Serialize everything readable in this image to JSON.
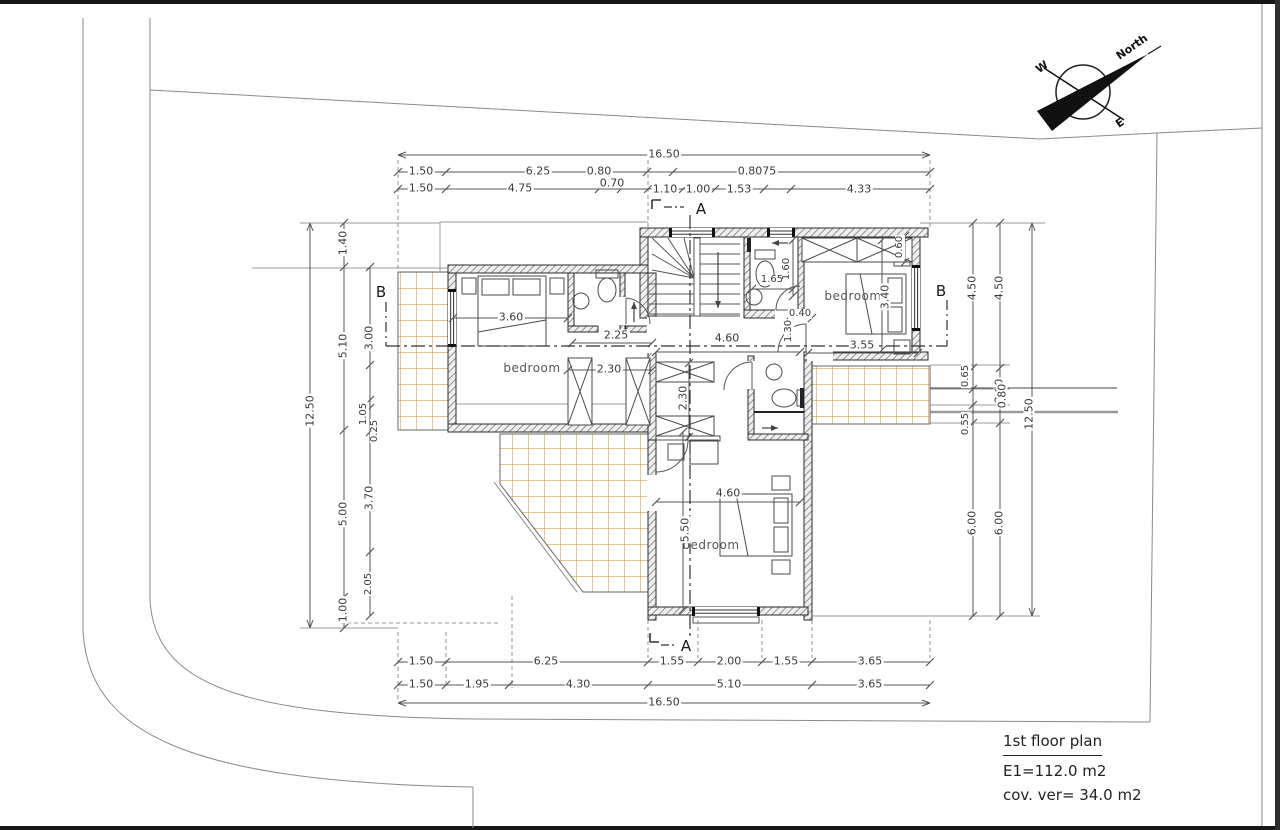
{
  "colors": {
    "tile_line": "#cfa24a",
    "wall_edge": "#2a2a2a",
    "hatch": "#7a7a7a",
    "dim_line": "#555555",
    "text": "#3a3a3a",
    "border": "#161616"
  },
  "title_block": {
    "title": "1st floor plan",
    "area": "E1=112.0 m2",
    "covered_veranda": "cov. ver= 34.0 m2"
  },
  "compass": {
    "north": "North",
    "west": "W",
    "south": "S",
    "east": "E"
  },
  "section_markers": {
    "a_top": "A",
    "a_bottom": "A",
    "b_left": "B",
    "b_right": "B"
  },
  "rooms": [
    {
      "label": "bedroom"
    },
    {
      "label": "bedroom"
    },
    {
      "label": "bedroom"
    }
  ],
  "dim_labels": {
    "top": [
      {
        "t": "16.50",
        "x": 664,
        "y": 154
      },
      {
        "t": "1.50",
        "x": 421,
        "y": 171
      },
      {
        "t": "6.25",
        "x": 538,
        "y": 171
      },
      {
        "t": "0.80",
        "x": 599,
        "y": 171
      },
      {
        "t": "0.8075",
        "x": 757,
        "y": 171
      },
      {
        "t": "1.50",
        "x": 421,
        "y": 188
      },
      {
        "t": "4.75",
        "x": 520,
        "y": 188
      },
      {
        "t": "0.70",
        "x": 612,
        "y": 183
      },
      {
        "t": "1.10",
        "x": 665,
        "y": 189
      },
      {
        "t": "1.00",
        "x": 698,
        "y": 189
      },
      {
        "t": "1.53",
        "x": 739,
        "y": 189
      },
      {
        "t": "4.33",
        "x": 859,
        "y": 189
      }
    ],
    "bottom": [
      {
        "t": "1.50",
        "x": 421,
        "y": 661
      },
      {
        "t": "6.25",
        "x": 546,
        "y": 661
      },
      {
        "t": "1.55",
        "x": 672,
        "y": 661
      },
      {
        "t": "2.00",
        "x": 729,
        "y": 661
      },
      {
        "t": "1.55",
        "x": 786,
        "y": 661
      },
      {
        "t": "3.65",
        "x": 870,
        "y": 661
      },
      {
        "t": "1.50",
        "x": 421,
        "y": 684
      },
      {
        "t": "1.95",
        "x": 477,
        "y": 684
      },
      {
        "t": "4.30",
        "x": 578,
        "y": 684
      },
      {
        "t": "5.10",
        "x": 729,
        "y": 684
      },
      {
        "t": "3.65",
        "x": 870,
        "y": 684
      },
      {
        "t": "16.50",
        "x": 664,
        "y": 702
      }
    ],
    "left": [
      {
        "t": "12.50",
        "x": 310,
        "y": 411,
        "v": 1
      },
      {
        "t": "1.40",
        "x": 343,
        "y": 243,
        "v": 1
      },
      {
        "t": "5.10",
        "x": 343,
        "y": 346,
        "v": 1
      },
      {
        "t": "5.00",
        "x": 343,
        "y": 514,
        "v": 1
      },
      {
        "t": "1.00",
        "x": 343,
        "y": 610,
        "v": 1
      },
      {
        "t": "3.00",
        "x": 369,
        "y": 338,
        "v": 1
      },
      {
        "t": "1.05",
        "x": 364,
        "y": 414,
        "v": 1,
        "s": 1
      },
      {
        "t": "0.25",
        "x": 375,
        "y": 431,
        "v": 1,
        "s": 1
      },
      {
        "t": "3.70",
        "x": 369,
        "y": 498,
        "v": 1
      },
      {
        "t": "2.05",
        "x": 369,
        "y": 584,
        "v": 1,
        "s": 1
      }
    ],
    "right": [
      {
        "t": "4.50",
        "x": 972,
        "y": 288,
        "v": 1
      },
      {
        "t": "0.65",
        "x": 966,
        "y": 376,
        "v": 1,
        "s": 1
      },
      {
        "t": "0.55",
        "x": 966,
        "y": 424,
        "v": 1,
        "s": 1
      },
      {
        "t": "6.00",
        "x": 972,
        "y": 523,
        "v": 1
      },
      {
        "t": "4.50",
        "x": 999,
        "y": 288,
        "v": 1
      },
      {
        "t": "2.60",
        "x": 999,
        "y": 391,
        "v": 1
      },
      {
        "t": "0.80",
        "x": 1002,
        "y": 396,
        "v": 1
      },
      {
        "t": "6.00",
        "x": 999,
        "y": 523,
        "v": 1
      },
      {
        "t": "12.50",
        "x": 1029,
        "y": 414,
        "v": 1
      }
    ],
    "interior": [
      {
        "t": "3.60",
        "x": 511,
        "y": 317
      },
      {
        "t": "2.25",
        "x": 616,
        "y": 335
      },
      {
        "t": "2.30",
        "x": 609,
        "y": 369
      },
      {
        "t": "4.60",
        "x": 727,
        "y": 338
      },
      {
        "t": "3.55",
        "x": 862,
        "y": 345
      },
      {
        "t": "1.65",
        "x": 772,
        "y": 280,
        "s": 1
      },
      {
        "t": "0.40",
        "x": 800,
        "y": 314,
        "s": 1
      },
      {
        "t": "3.40",
        "x": 885,
        "y": 297,
        "v": 1
      },
      {
        "t": "0.60",
        "x": 900,
        "y": 247,
        "v": 1,
        "s": 1
      },
      {
        "t": "1.60",
        "x": 787,
        "y": 269,
        "v": 1,
        "s": 1
      },
      {
        "t": "1.30",
        "x": 789,
        "y": 331,
        "v": 1,
        "s": 1
      },
      {
        "t": "2.30",
        "x": 683,
        "y": 398,
        "v": 1
      },
      {
        "t": "4.60",
        "x": 728,
        "y": 493
      },
      {
        "t": "5.50",
        "x": 685,
        "y": 530,
        "v": 1
      }
    ]
  }
}
